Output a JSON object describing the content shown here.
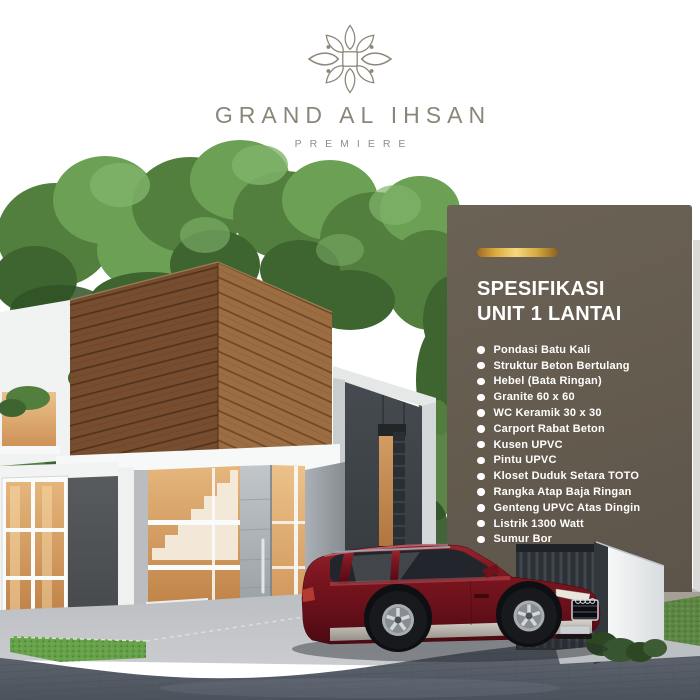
{
  "brand": {
    "title": "GRAND AL IHSAN",
    "subtitle": "PREMIERE",
    "text_color": "#8c8679"
  },
  "spec_panel": {
    "heading_line1": "SPESIFIKASI",
    "heading_line2": "UNIT 1 LANTAI",
    "items": [
      "Pondasi Batu Kali",
      "Struktur Beton Bertulang",
      "Hebel (Bata Ringan)",
      "Granite 60 x 60",
      "WC Keramik 30 x 30",
      "Carport Rabat Beton",
      "Kusen UPVC",
      "Pintu UPVC",
      "Kloset Duduk Setara TOTO",
      "Rangka Atap Baja Ringan",
      "Genteng UPVC Atas Dingin",
      "Listrik 1300 Watt",
      "Sumur Bor"
    ],
    "colors": {
      "panel_bg": "#655c50",
      "accent_gold": "#d8a83c",
      "text": "#ffffff"
    }
  },
  "scene": {
    "colors": {
      "wood_cladding": "#8a5a34",
      "foliage_green": "#578c43",
      "car_paint_red": "#7c161f",
      "charcoal_wall": "#3f454a",
      "warm_window_light": "#d8a369",
      "road_asphalt": "#59606b"
    }
  }
}
